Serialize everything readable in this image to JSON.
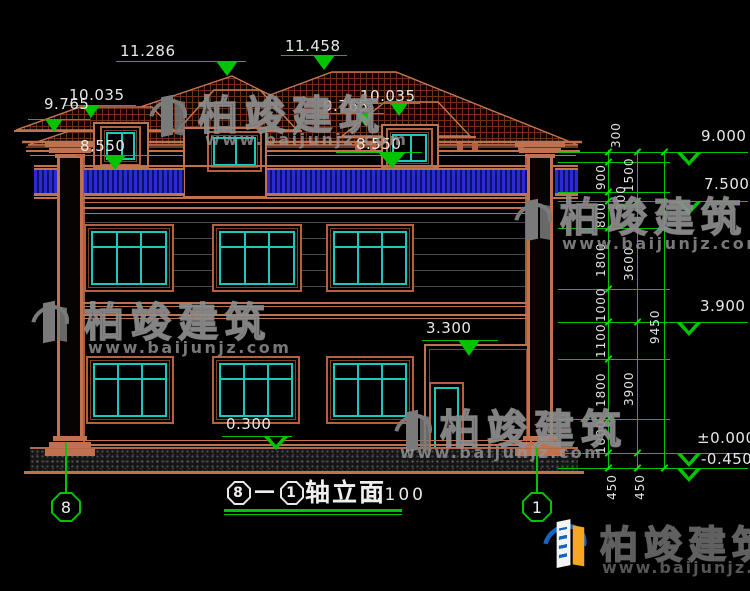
{
  "drawing": {
    "type": "house-elevation-cad",
    "background": "#000000"
  },
  "title": {
    "bubble_start": "8",
    "dash": "－",
    "bubble_end": "1",
    "text": "轴立面",
    "scale": "1:100"
  },
  "axis": {
    "left_bubble": "8",
    "right_bubble": "1"
  },
  "levels": {
    "ridge_left": "11.286",
    "ridge_main": "11.458",
    "left_upper_eave": "10.035",
    "left_lower_eave": "9.765",
    "left_parapet": "8.550",
    "mid_lower_eave": "9.765",
    "mid_upper_eave": "10.035",
    "mid_parapet": "8.550",
    "porch_roof": "3.300",
    "porch_plinth": "0.300",
    "r_top": "9.000",
    "r_second": "7.500",
    "r_first": "3.900",
    "r_zero": "±0.000",
    "r_grade": "-0.450"
  },
  "dims": {
    "chain_a": [
      "300",
      "900",
      "300",
      "800",
      "1800",
      "1000",
      "1100",
      "1800",
      "1000"
    ],
    "chain_b": [
      "1500",
      "3600",
      "3900"
    ],
    "overall": "9450",
    "bottom_left": "450",
    "bottom_right": "450"
  },
  "watermark": {
    "brand": "柏竣建筑",
    "url": "www.baijunjz.com"
  },
  "colors": {
    "dim_green": "#00c400",
    "wall_red": "#c0714e",
    "window_teal": "#1ac8bc",
    "railing_blue": "#2b2bd6",
    "logo_blue": "#1565c0",
    "logo_orange": "#f5a623"
  }
}
